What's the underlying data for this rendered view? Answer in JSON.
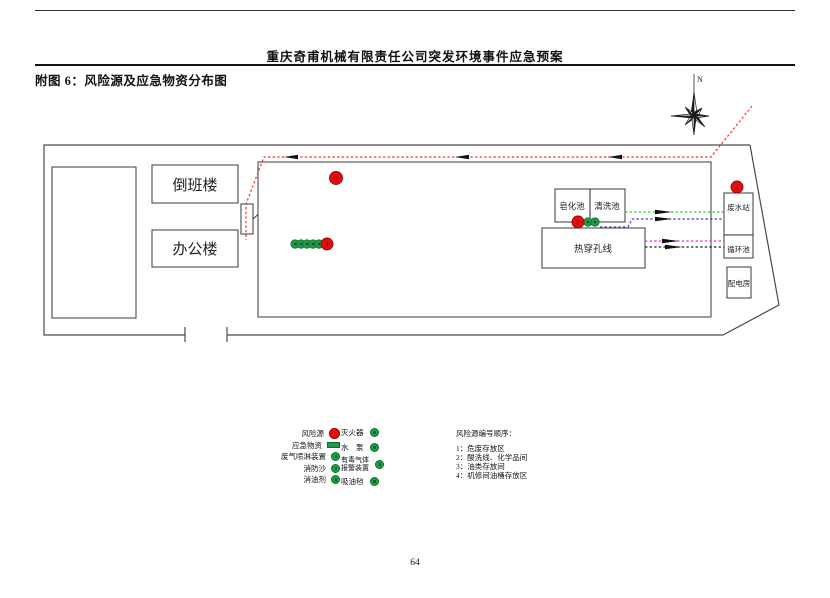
{
  "page": {
    "header_title": "重庆奇甫机械有限责任公司突发环境事件应急预案",
    "figure_title": "附图 6：风险源及应急物资分布图",
    "page_number": "64"
  },
  "compass": {
    "label": "N"
  },
  "map": {
    "labels": {
      "shift_building": "倒班楼",
      "office_building": "办公楼",
      "biochemical_pool": "生化池",
      "saponification_pool": "皂化池",
      "cleaning_pool": "清洗池",
      "hot_piercing_line": "热穿孔线",
      "wastewater_station": "废水站",
      "circulation_pool": "循环池",
      "power_room": "配电房"
    },
    "risk_markers": {
      "hazardous_waste": "1",
      "acid_wash": "2",
      "oil_storage": "3",
      "machine_repair": "4"
    }
  },
  "legend": {
    "left": [
      {
        "label": "风险源",
        "marker": "red-circle"
      },
      {
        "label": "应急物资",
        "marker": "green-rect"
      },
      {
        "label": "废气喷淋装置",
        "marker": "green-circle"
      },
      {
        "label": "消防沙",
        "marker": "green-circle"
      },
      {
        "label": "消油剂",
        "marker": "green-circle"
      }
    ],
    "right": [
      {
        "label": "灭火器",
        "marker": "green-circle"
      },
      {
        "label": "水　泵",
        "marker": "green-circle"
      },
      {
        "label": "有毒气体",
        "label2": "报警装置",
        "marker": "green-circle"
      },
      {
        "label": "吸油毡",
        "marker": "green-circle"
      }
    ],
    "risk_list": {
      "title": "风险源编号顺序：",
      "items": [
        "1：危废存放区",
        "2：酸洗线、化学品间",
        "3：油类存放间",
        "4：机修间油桶存放区"
      ]
    }
  },
  "colors": {
    "risk_red": "#e01010",
    "supply_green": "#1fa048",
    "route_red": "#f53030",
    "line_green": "#2ecc40",
    "line_blue": "#3a3ad0",
    "line_magenta": "#e832e8",
    "line_black": "#222222"
  }
}
